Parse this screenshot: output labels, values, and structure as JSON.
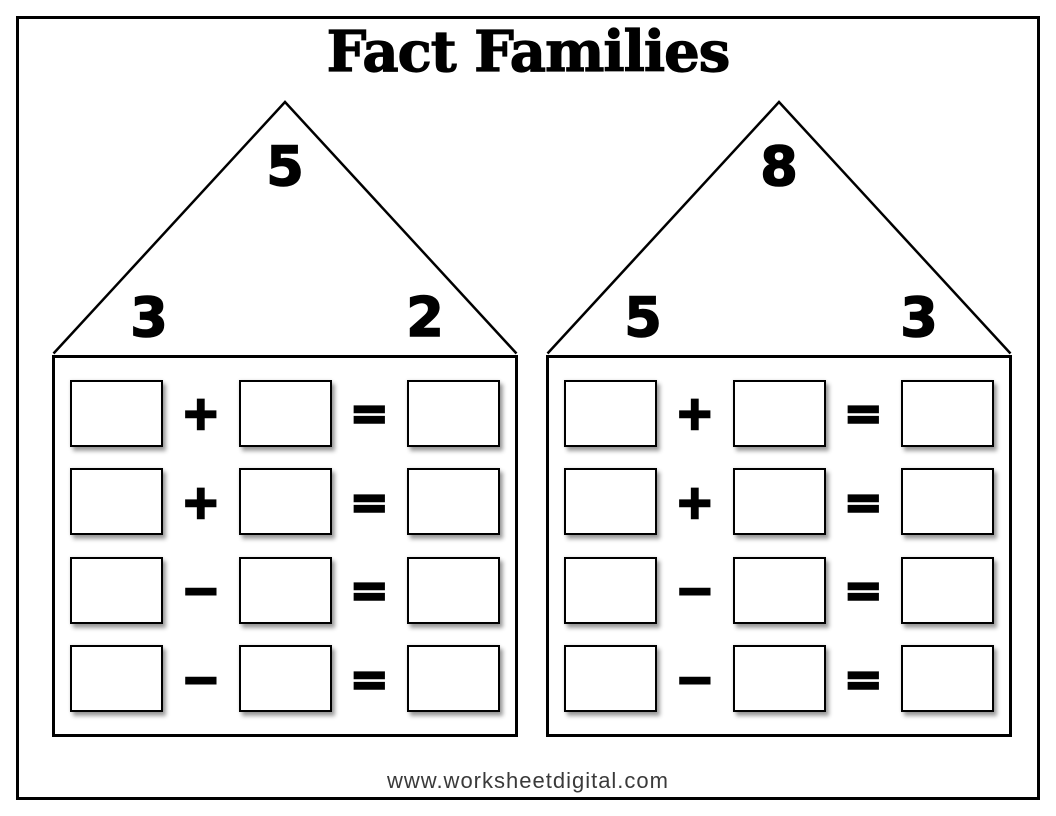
{
  "page": {
    "title": "Fact Families",
    "footer_url": "www.worksheetdigital.com",
    "background_color": "#ffffff",
    "ink_color": "#000000",
    "footer_text_color": "#3a3a3a"
  },
  "houses": [
    {
      "name": "left-house",
      "roof": {
        "top_number": "5",
        "left_number": "3",
        "right_number": "2"
      },
      "rows": [
        {
          "first": "",
          "operator": "+",
          "second": "",
          "equals": "=",
          "result": ""
        },
        {
          "first": "",
          "operator": "+",
          "second": "",
          "equals": "=",
          "result": ""
        },
        {
          "first": "",
          "operator": "−",
          "second": "",
          "equals": "=",
          "result": ""
        },
        {
          "first": "",
          "operator": "−",
          "second": "",
          "equals": "=",
          "result": ""
        }
      ]
    },
    {
      "name": "right-house",
      "roof": {
        "top_number": "8",
        "left_number": "5",
        "right_number": "3"
      },
      "rows": [
        {
          "first": "",
          "operator": "+",
          "second": "",
          "equals": "=",
          "result": ""
        },
        {
          "first": "",
          "operator": "+",
          "second": "",
          "equals": "=",
          "result": ""
        },
        {
          "first": "",
          "operator": "−",
          "second": "",
          "equals": "=",
          "result": ""
        },
        {
          "first": "",
          "operator": "−",
          "second": "",
          "equals": "=",
          "result": ""
        }
      ]
    }
  ]
}
